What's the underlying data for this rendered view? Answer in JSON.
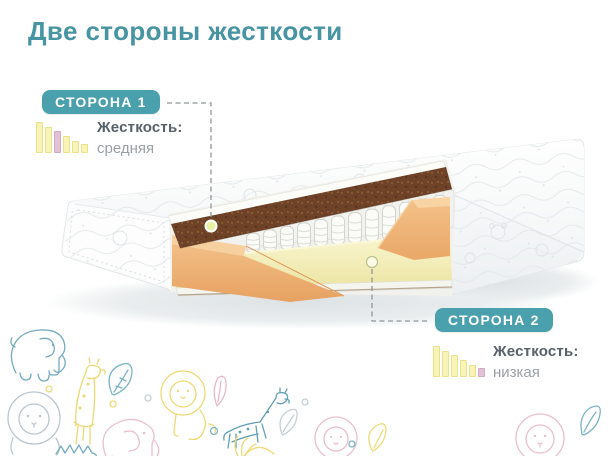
{
  "title": {
    "text": "Две стороны жесткости"
  },
  "colors": {
    "title_teal": "#4794a3",
    "accent_teal": "#4aa0ac",
    "label_dark": "#57616b",
    "value_gray": "#99a1a8",
    "bar_yellow": "#f7f4b5",
    "bar_yellow_border": "#e9e18d",
    "bar_pink": "#e3c2d6",
    "bar_pink_border": "#d2a9c3",
    "dashed_line": "#8e969a",
    "coir_brown": "#6e4226",
    "foam_orange": "#efb278",
    "soft_foam_yellow": "#f5efb9"
  },
  "callout_side1": {
    "badge": "СТОРОНА 1",
    "label": "Жесткость:",
    "value": "средняя",
    "firmness": {
      "heights": [
        100,
        85,
        70,
        55,
        40,
        29
      ],
      "highlight_index": 2
    }
  },
  "callout_side2": {
    "badge": "СТОРОНА 2",
    "label": "Жесткость:",
    "value": "низкая",
    "firmness": {
      "heights": [
        100,
        85,
        70,
        55,
        40,
        29
      ],
      "highlight_index": 5
    }
  },
  "illustration": {
    "type": "mattress-cutaway",
    "layers": [
      "quilted-cover",
      "coir-layer",
      "pocket-springs",
      "foam-frame",
      "soft-foam-layer"
    ],
    "markers": [
      "side1-dot-on-coir-layer",
      "side2-dot-on-soft-layer"
    ]
  },
  "decorations": [
    {
      "name": "elephant",
      "color": "teal"
    },
    {
      "name": "lion",
      "color": "gray"
    },
    {
      "name": "giraffe",
      "color": "yellow"
    },
    {
      "name": "leaf",
      "color": "teal"
    },
    {
      "name": "lion",
      "color": "yellow"
    },
    {
      "name": "elephant",
      "color": "pink"
    },
    {
      "name": "leaf",
      "color": "pink"
    },
    {
      "name": "giraffe",
      "color": "teal"
    },
    {
      "name": "leaf",
      "color": "gray"
    },
    {
      "name": "lion",
      "color": "pink"
    },
    {
      "name": "hedgehog",
      "color": "teal"
    },
    {
      "name": "grass",
      "color": "yellow"
    },
    {
      "name": "leaf",
      "color": "yellow"
    },
    {
      "name": "lion",
      "color": "pink"
    },
    {
      "name": "leaf",
      "color": "teal"
    }
  ]
}
